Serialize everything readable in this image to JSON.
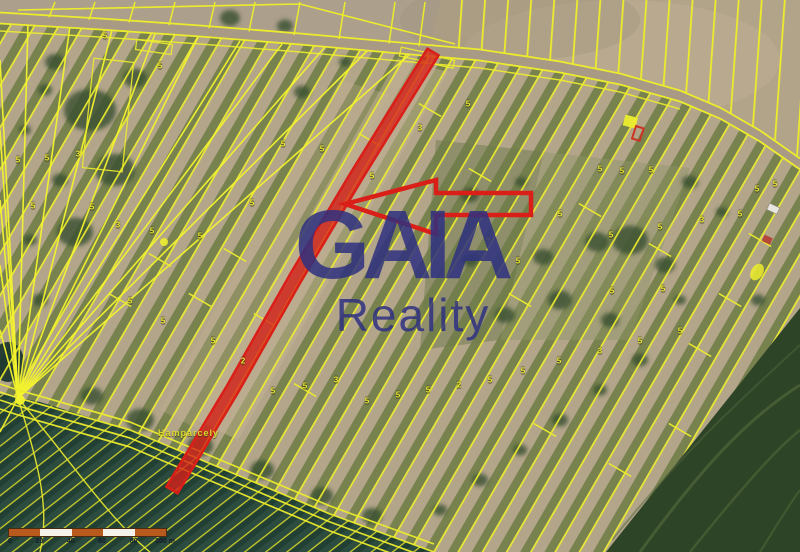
{
  "watermark": {
    "line1": "GAIA",
    "line2": "Reality",
    "color": "#2e3180"
  },
  "scale_bar": {
    "labels": [
      "0",
      "20",
      "40",
      "60",
      "80",
      "100 m"
    ],
    "segment_colors": [
      "#b85a1d",
      "#f4f2ea",
      "#b85a1d",
      "#f4f2ea",
      "#b85a1d"
    ]
  },
  "place_label": {
    "text": "Hamparcely"
  },
  "map": {
    "colors": {
      "parcel_line": "#ecec2c",
      "parcel_line_bright": "#f4f42e",
      "highlight": "#d91f18",
      "highlight_fill": "rgba(216,32,26,0.78)"
    },
    "parcel_numbers": [
      {
        "x": 105,
        "y": 36,
        "t": "5"
      },
      {
        "x": 160,
        "y": 66,
        "t": "5"
      },
      {
        "x": 18,
        "y": 160,
        "t": "5"
      },
      {
        "x": 47,
        "y": 158,
        "t": "5"
      },
      {
        "x": 78,
        "y": 154,
        "t": "3"
      },
      {
        "x": 283,
        "y": 144,
        "t": "5"
      },
      {
        "x": 322,
        "y": 149,
        "t": "5"
      },
      {
        "x": 372,
        "y": 176,
        "t": "5"
      },
      {
        "x": 420,
        "y": 128,
        "t": "3"
      },
      {
        "x": 468,
        "y": 104,
        "t": "5"
      },
      {
        "x": 33,
        "y": 206,
        "t": "5"
      },
      {
        "x": 92,
        "y": 207,
        "t": "5"
      },
      {
        "x": 118,
        "y": 225,
        "t": "3"
      },
      {
        "x": 152,
        "y": 231,
        "t": "5"
      },
      {
        "x": 200,
        "y": 236,
        "t": "5"
      },
      {
        "x": 252,
        "y": 203,
        "t": "5"
      },
      {
        "x": 130,
        "y": 301,
        "t": "5"
      },
      {
        "x": 163,
        "y": 321,
        "t": "5"
      },
      {
        "x": 213,
        "y": 341,
        "t": "5"
      },
      {
        "x": 243,
        "y": 361,
        "t": "2"
      },
      {
        "x": 273,
        "y": 391,
        "t": "5"
      },
      {
        "x": 305,
        "y": 386,
        "t": "5"
      },
      {
        "x": 336,
        "y": 380,
        "t": "3"
      },
      {
        "x": 367,
        "y": 401,
        "t": "5"
      },
      {
        "x": 398,
        "y": 395,
        "t": "5"
      },
      {
        "x": 428,
        "y": 390,
        "t": "5"
      },
      {
        "x": 459,
        "y": 385,
        "t": "2"
      },
      {
        "x": 490,
        "y": 380,
        "t": "5"
      },
      {
        "x": 523,
        "y": 371,
        "t": "5"
      },
      {
        "x": 559,
        "y": 361,
        "t": "5"
      },
      {
        "x": 600,
        "y": 351,
        "t": "3"
      },
      {
        "x": 640,
        "y": 341,
        "t": "5"
      },
      {
        "x": 680,
        "y": 331,
        "t": "5"
      },
      {
        "x": 600,
        "y": 169,
        "t": "5"
      },
      {
        "x": 622,
        "y": 171,
        "t": "5"
      },
      {
        "x": 651,
        "y": 170,
        "t": "5"
      },
      {
        "x": 611,
        "y": 235,
        "t": "5"
      },
      {
        "x": 660,
        "y": 227,
        "t": "5"
      },
      {
        "x": 702,
        "y": 220,
        "t": "3"
      },
      {
        "x": 740,
        "y": 214,
        "t": "5"
      },
      {
        "x": 518,
        "y": 261,
        "t": "5"
      },
      {
        "x": 612,
        "y": 291,
        "t": "5"
      },
      {
        "x": 663,
        "y": 289,
        "t": "5"
      },
      {
        "x": 757,
        "y": 189,
        "t": "5"
      },
      {
        "x": 775,
        "y": 184,
        "t": "5"
      },
      {
        "x": 488,
        "y": 240,
        "t": "9"
      },
      {
        "x": 560,
        "y": 214,
        "t": "5"
      }
    ]
  }
}
